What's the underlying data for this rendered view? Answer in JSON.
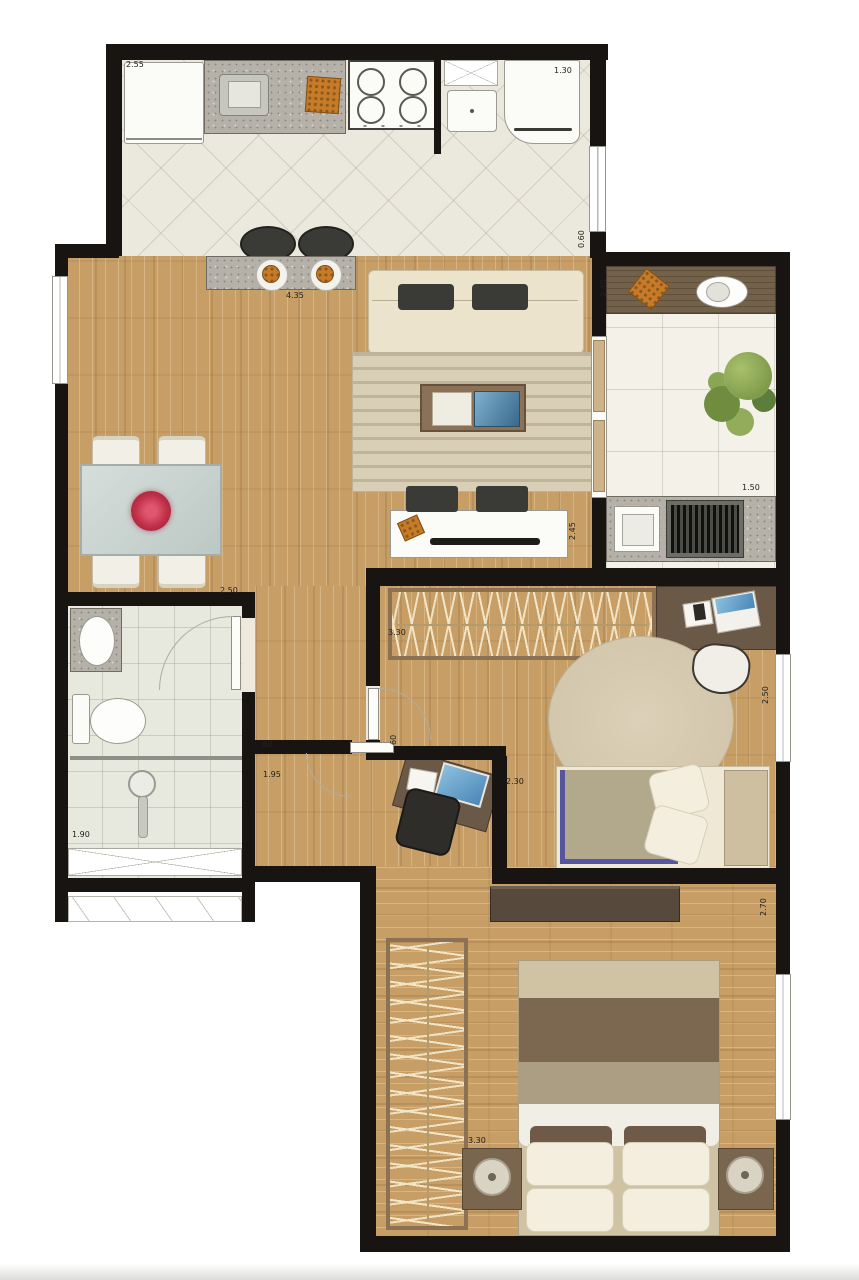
{
  "plan": {
    "title": "apartment-floor-plan",
    "rooms": [
      "kitchen",
      "service-area",
      "living-dining",
      "balcony",
      "bathroom",
      "hallway",
      "home-office-nook",
      "bedroom-1",
      "bedroom-2"
    ],
    "dimension_labels": [
      {
        "text": "2.55",
        "x": 126,
        "y": 60,
        "vertical": false
      },
      {
        "text": "1.30",
        "x": 554,
        "y": 66,
        "vertical": false
      },
      {
        "text": "0.60",
        "x": 577,
        "y": 248,
        "vertical": true
      },
      {
        "text": "2.40",
        "x": 599,
        "y": 297,
        "vertical": true
      },
      {
        "text": "4.35",
        "x": 286,
        "y": 291,
        "vertical": false
      },
      {
        "text": "2.45",
        "x": 568,
        "y": 540,
        "vertical": true
      },
      {
        "text": "2.50",
        "x": 220,
        "y": 586,
        "vertical": false
      },
      {
        "text": "1.50",
        "x": 742,
        "y": 483,
        "vertical": false
      },
      {
        "text": "3.30",
        "x": 388,
        "y": 628,
        "vertical": false
      },
      {
        "text": "2.50",
        "x": 761,
        "y": 704,
        "vertical": true
      },
      {
        "text": "2.30",
        "x": 506,
        "y": 777,
        "vertical": false
      },
      {
        "text": ".60",
        "x": 260,
        "y": 740,
        "vertical": false
      },
      {
        "text": "1.95",
        "x": 263,
        "y": 770,
        "vertical": false
      },
      {
        "text": "60",
        "x": 389,
        "y": 745,
        "vertical": true
      },
      {
        "text": "1.90",
        "x": 72,
        "y": 830,
        "vertical": false
      },
      {
        "text": "2.70",
        "x": 759,
        "y": 916,
        "vertical": true
      },
      {
        "text": "3.30",
        "x": 468,
        "y": 1136,
        "vertical": false
      }
    ],
    "palette": {
      "wall": "#171412",
      "wood": "#c79e66",
      "kitchen-tile": "#ebe9de",
      "balcony-tile": "#f3f1e8",
      "bath-tile": "#e7e8de",
      "granite": "#b5b1a8",
      "wood-counter": "#73614a",
      "wardrobe": "#dcc08c",
      "accent-food": "#c77a28",
      "flower": "#c03048",
      "plant": "#7f9c4c",
      "screen-blue": "#4a86b8",
      "rug": "#d8cfb6",
      "dark-furniture": "#3a3a36"
    }
  }
}
